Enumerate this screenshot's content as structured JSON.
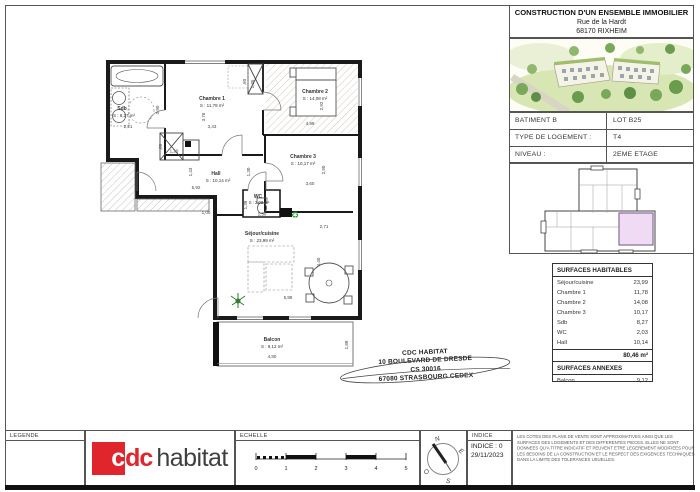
{
  "title_block": {
    "line1": "CONSTRUCTION D'UN ENSEMBLE IMMOBILIER",
    "line2": "Rue de la Hardt",
    "line3": "68170 RIXHEIM"
  },
  "info_table": {
    "rows": [
      {
        "label": "BATIMENT B",
        "value": "LOT B25"
      },
      {
        "label": "TYPE DE LOGEMENT :",
        "value": "T4"
      },
      {
        "label": "NIVEAU :",
        "value": "2EME ETAGE"
      }
    ]
  },
  "surfaces": {
    "habitables_title": "SURFACES HABITABLES",
    "rows": [
      {
        "label": "Séjour/cuisine",
        "value": "23,99"
      },
      {
        "label": "Chambre 1",
        "value": "11,78"
      },
      {
        "label": "Chambre 2",
        "value": "14,08"
      },
      {
        "label": "Chambre 3",
        "value": "10,17"
      },
      {
        "label": "Sdb",
        "value": "8,27"
      },
      {
        "label": "WC",
        "value": "2,03"
      },
      {
        "label": "Hall",
        "value": "10,14"
      }
    ],
    "total": "80,46 m²",
    "annexes_title": "SURFACES ANNEXES",
    "annexes_rows": [
      {
        "label": "Balcon",
        "value": "9,12"
      }
    ]
  },
  "address": {
    "line1": "CDC HABITAT",
    "line2": "10 BOULEVARD DE DRESDE",
    "line3": "CS 30016",
    "line4": "67080 STRASBOURG CEDEX"
  },
  "plan": {
    "rooms": {
      "sdb": {
        "name": "Sdb",
        "area": "S : 8,27 m²"
      },
      "chambre1": {
        "name": "Chambre 1",
        "area": "S : 11,78 m²"
      },
      "chambre2": {
        "name": "Chambre 2",
        "area": "S : 14,08 m²"
      },
      "chambre3": {
        "name": "Chambre 3",
        "area": "S : 10,17 m²"
      },
      "hall": {
        "name": "Hall",
        "area": "S : 10,14 m²"
      },
      "wc": {
        "name": "WC",
        "area": "S : 2,03 m²"
      },
      "sejour": {
        "name": "Séjour/cuisine",
        "area": "S : 23,99 m²"
      },
      "balcon": {
        "name": "Balcon",
        "area": "S : 9,12 m²"
      }
    },
    "dims": {
      "sdb_w": "2,21",
      "sdb_h": "3,90",
      "ch1_w": "3,43",
      "ch1_h": "3,76",
      "ch2_w": "4,99",
      "ch2_h": "2,92",
      "ch3_w": "3,60",
      "ch3_h": "2,90",
      "hall_w": "5,92",
      "hall_h": "1,43",
      "hall_d": "1,30",
      "wc_h": "1,38",
      "wc_w": "1,50",
      "wc_d": "1,00",
      "sejour_w": "5,88",
      "sejour_h": "4,40",
      "sejour_d": "2,71",
      "balcon_w": "4,80",
      "balcon_h": "1,88",
      "closet1_w": "1,20",
      "closet1_h": ",60",
      "closet2_w": ",60",
      "closet2_h": "1,35"
    }
  },
  "footer": {
    "legende": "LEGENDE",
    "logo_c": "c",
    "logo_dc": "dc",
    "logo_habitat": "habitat",
    "echelle": "ECHELLE",
    "scale_numbers": [
      "0",
      "1",
      "2",
      "3",
      "4",
      "5"
    ],
    "compass": {
      "n": "N",
      "e": "E",
      "s": "S",
      "o": "O"
    },
    "indice_header": "INDICE",
    "indice": "INDICE : 0",
    "date": "29/11/2023",
    "disclaimer": "LES COTES DES PLANS DE VENTE SONT APPROXIMATIVES AINSI QUE LES SURFACES DES LOGEMENTS ET DES DIFFERENTES PIECES. ELLES NE SONT DONNEES QU'A TITRE INDICATIF ET PEUVENT ETRE LEGEREMENT MODIFIEES POUR LES BESOINS DE LA CONSTRUCTION ET LE RESPECT DES EXIGENCES TECHNIQUES DANS LA LIMITE DES TOLERANCES USUELLES.",
    "colors": {
      "brand_red": "#e0262c",
      "keyplan_highlight": "#efdbf3",
      "plant_green": "#2e7d32"
    }
  }
}
